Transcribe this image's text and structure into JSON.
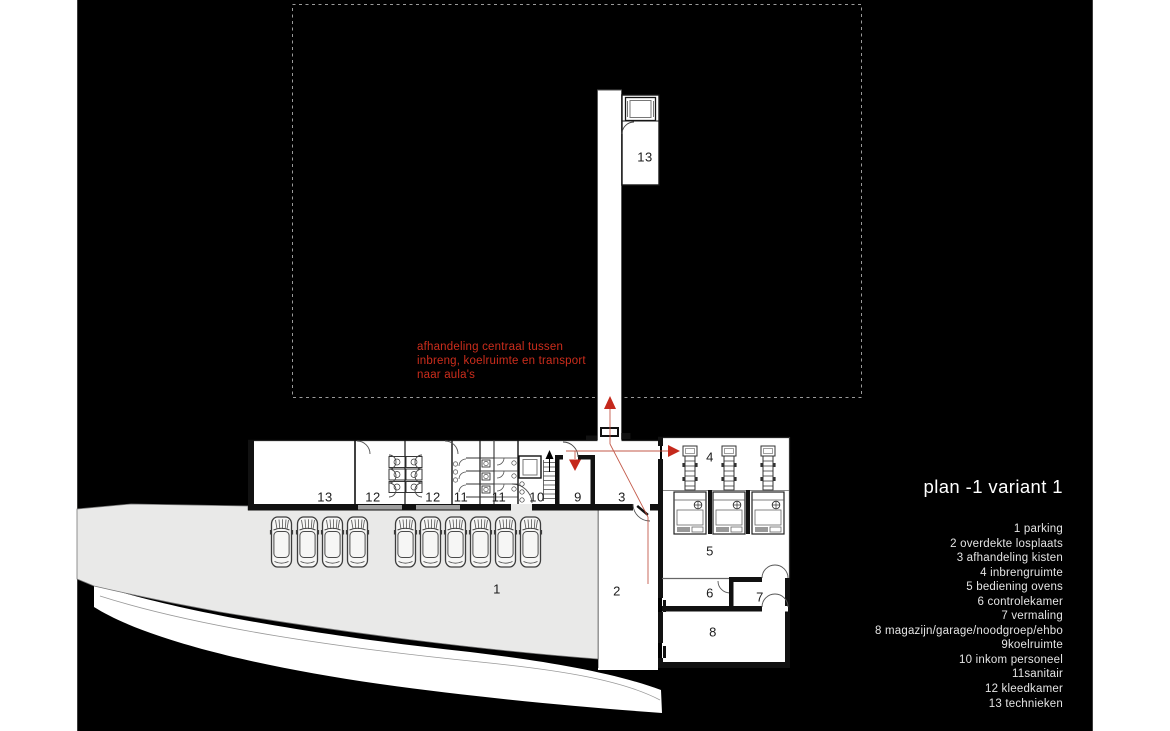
{
  "title": {
    "text": "plan -1 variant 1"
  },
  "annotation": {
    "lines": [
      "afhandeling centraal tussen",
      "inbreng, koelruimte en transport",
      "naar aula's"
    ],
    "color": "#cc2d1c"
  },
  "legend": {
    "items": [
      "1 parking",
      "2 overdekte losplaats",
      "3 afhandeling kisten",
      "4 inbrengruimte",
      "5 bediening ovens",
      "6 controlekamer",
      "7 vermaling",
      "8 magazijn/garage/noodgroep/ehbo",
      "9koelruimte",
      "10 inkom personeel",
      "11sanitair",
      "12 kleedkamer",
      "13 technieken"
    ]
  },
  "plan": {
    "room_labels": [
      {
        "n": "13",
        "x": 645,
        "y": 157
      },
      {
        "n": "13",
        "x": 325,
        "y": 497
      },
      {
        "n": "12",
        "x": 373,
        "y": 497
      },
      {
        "n": "12",
        "x": 433,
        "y": 497
      },
      {
        "n": "11",
        "x": 461,
        "y": 497
      },
      {
        "n": "11",
        "x": 499,
        "y": 497
      },
      {
        "n": "10",
        "x": 537,
        "y": 497
      },
      {
        "n": "9",
        "x": 578,
        "y": 497
      },
      {
        "n": "3",
        "x": 622,
        "y": 497
      },
      {
        "n": "4",
        "x": 710,
        "y": 457
      },
      {
        "n": "5",
        "x": 710,
        "y": 551
      },
      {
        "n": "6",
        "x": 710,
        "y": 593
      },
      {
        "n": "7",
        "x": 760,
        "y": 597
      },
      {
        "n": "8",
        "x": 713,
        "y": 632
      },
      {
        "n": "2",
        "x": 617,
        "y": 591
      },
      {
        "n": "1",
        "x": 497,
        "y": 589
      }
    ],
    "parking": {
      "car_count": 10
    },
    "colors": {
      "canvas": "#000000",
      "parking_gray": "#e9e9e8",
      "accent_red": "#c5291c",
      "dash_gray": "#9a9a9a"
    }
  }
}
